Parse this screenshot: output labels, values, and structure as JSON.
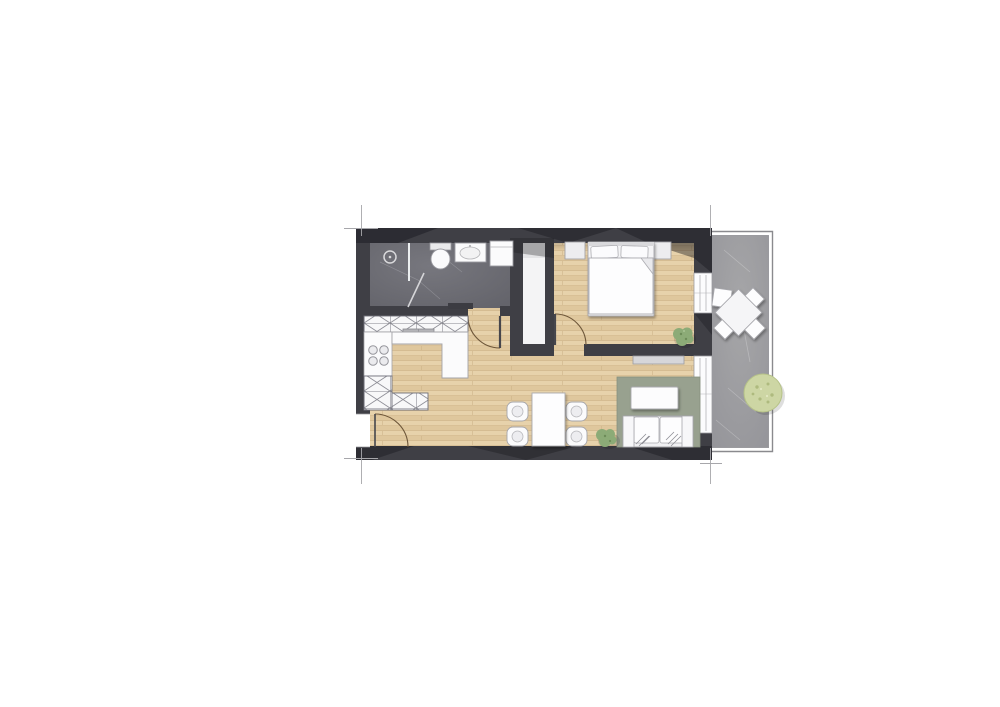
{
  "plan": {
    "type": "apartment-floor-plan",
    "rooms": [
      {
        "id": "bathroom",
        "floor": "dark-stone-tile",
        "fixtures": [
          "shower",
          "shower-glass-partition",
          "shower-glass-door",
          "toilet",
          "washbasin",
          "washing-machine",
          "radiator"
        ]
      },
      {
        "id": "kitchen",
        "floor": "wood-parquet",
        "fixtures": [
          "hatched-upper-cabinet-run",
          "sink-unit",
          "cooktop-4-burners",
          "l-shaped-counter",
          "hatched-lower-cabinets"
        ]
      },
      {
        "id": "living-dining",
        "floor": "wood-parquet",
        "fixtures": [
          "dining-table",
          "dining-chair x4",
          "potted-plant",
          "rug",
          "coffee-table",
          "sofa",
          "sideboard"
        ]
      },
      {
        "id": "bedroom",
        "floor": "wood-parquet",
        "fixtures": [
          "double-bed",
          "pillow x2",
          "duvet-with-fold",
          "nightstand x2",
          "potted-plant"
        ]
      },
      {
        "id": "hallway",
        "floor": "wood-parquet",
        "fixtures": []
      },
      {
        "id": "shaft-closet",
        "floor": "white",
        "fixtures": []
      },
      {
        "id": "terrace",
        "floor": "stone-tile",
        "fixtures": [
          "outdoor-table-rotated",
          "outdoor-chair x4",
          "round-shrub"
        ]
      }
    ],
    "doors": [
      "entrance-door-left-wall",
      "bathroom-door",
      "bedroom-door"
    ],
    "windows": [
      "bedroom-window-right-wall",
      "living-room-window-right-wall"
    ],
    "annotations": [
      "corner-tick-top-left",
      "corner-tick-top-right",
      "corner-tick-bottom-left",
      "corner-tick-bottom-right"
    ]
  },
  "palette": {
    "wall": "#3f3f45",
    "wall-shade": "#17171c",
    "bath-a": "#77777e",
    "bath-b": "#64646b",
    "terrace-a": "#a6a6a8",
    "terrace-b": "#95959a",
    "railing": "#8a8a8e",
    "fixture": "#fbfbfc",
    "fixture-line": "#a2a2a8",
    "hatch-line": "#8b8b93",
    "unit": "#b4b4b8",
    "rug": "#98a18f",
    "sideboard": "#d6d6d9",
    "plant": "#8cab77",
    "plant-dark": "#6d8c59",
    "bush": "#cdd6a4",
    "bush-dot": "#aeba7e",
    "arc": "#6d5639",
    "leaf": "#46464c",
    "tick": "#a7a7ab",
    "window": "#fcfcfd",
    "shaft": "#f4f4f5",
    "wood-a": "#e7d2ab",
    "wood-b": "#dfc79d",
    "wood-line": "#ccb086"
  }
}
